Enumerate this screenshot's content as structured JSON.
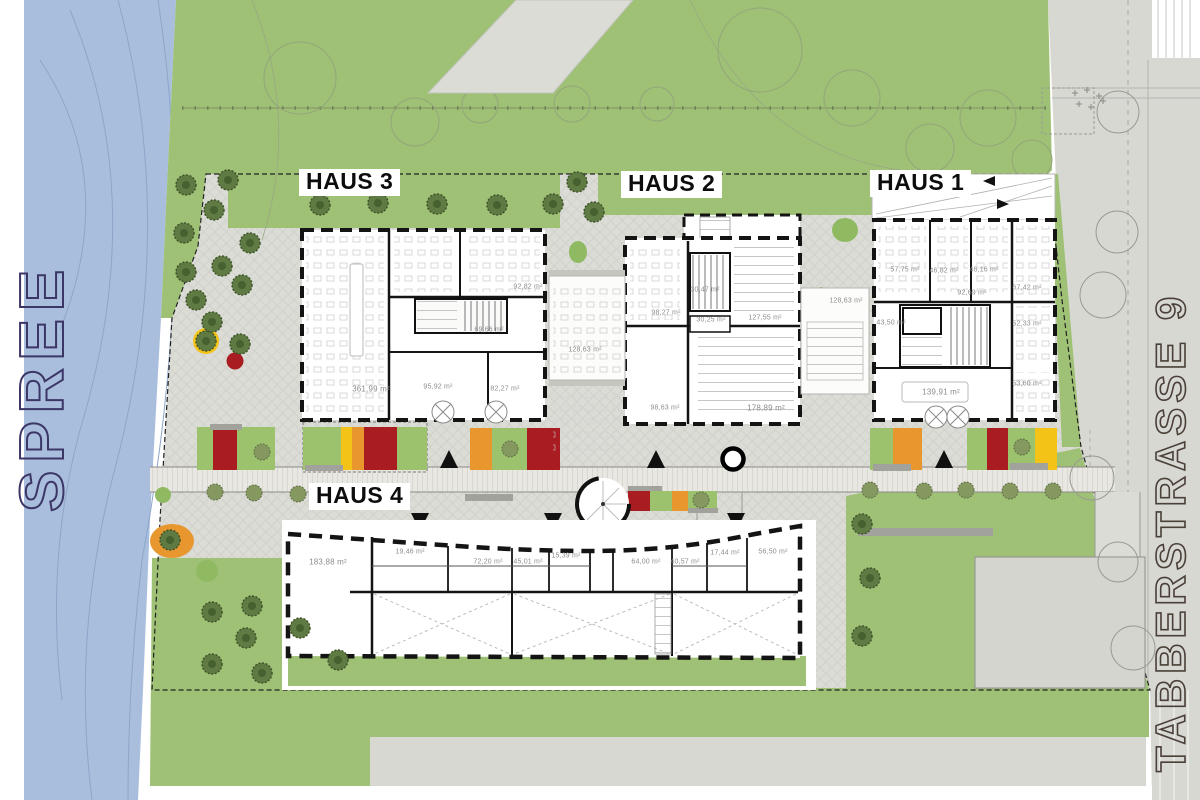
{
  "site": {
    "river_label": "SPREE",
    "street_label": "TABBERSTRASSE 9"
  },
  "buildings": {
    "haus1": {
      "label": "HAUS 1",
      "rooms": [
        "57,75 m²",
        "46,82 m²",
        "46,16 m²",
        "92,69 m²",
        "67,42 m²",
        "43,50 m²",
        "52,33 m²",
        "53,60 m²",
        "139,91 m²"
      ]
    },
    "haus2": {
      "label": "HAUS 2",
      "rooms": [
        "30,47 m²",
        "98,27 m²",
        "30,25 m²",
        "127,55 m²",
        "98,63 m²",
        "178,89 m²"
      ]
    },
    "haus3": {
      "label": "HAUS 3",
      "rooms": [
        "92,82 m²",
        "69,66 m²",
        "361,99 m²",
        "95,92 m²",
        "82,27 m²"
      ]
    },
    "haus4": {
      "label": "HAUS 4",
      "rooms": [
        "183,88 m²",
        "19,46 m²",
        "72,20 m²",
        "45,01 m²",
        "15,39 m²",
        "64,00 m²",
        "40,57 m²",
        "17,44 m²",
        "56,50 m²"
      ]
    },
    "wintergardens": {
      "left": "128,63 m²",
      "right": "128,63 m²"
    }
  },
  "colors": {
    "river": "#a9bedd",
    "green": "#9fc175",
    "plaza": "#dcdcd7",
    "street": "#d8d8d3",
    "road": "#e9e7e2",
    "accent_red": "#a81c22",
    "accent_orange": "#e8962e",
    "accent_yellow": "#f3c317",
    "accent_green": "#9cc26d",
    "wall": "#141414",
    "label_gray": "#8c8c8c",
    "tree_dark": "#5f7a42"
  }
}
